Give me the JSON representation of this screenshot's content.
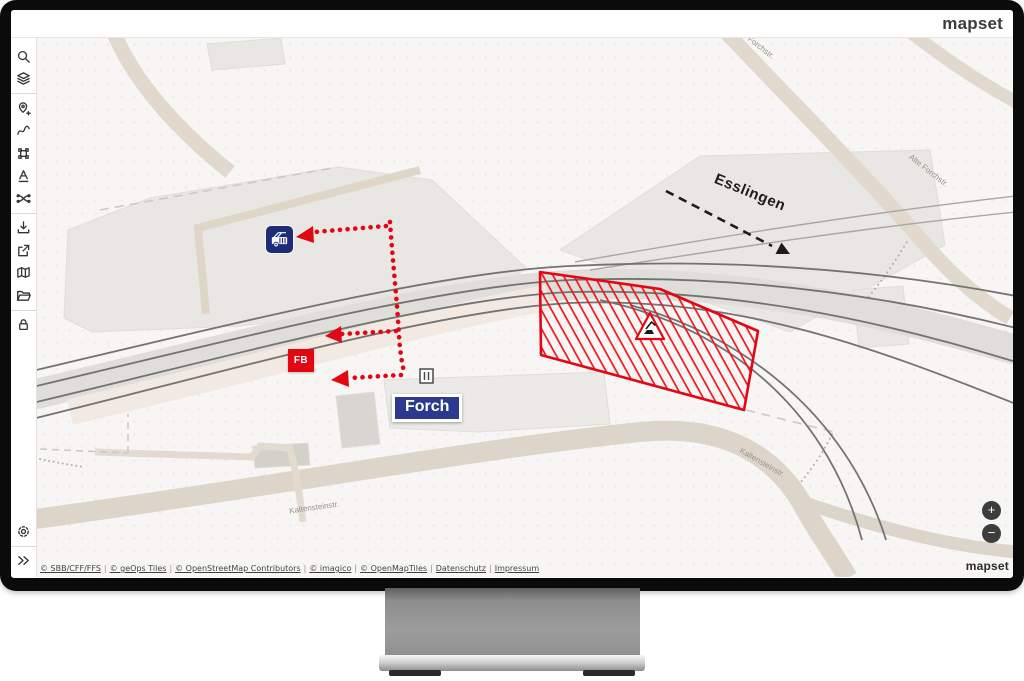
{
  "topbar": {
    "logo": "mapset"
  },
  "sidebar": {
    "icons": [
      "search",
      "layers",
      "add-location",
      "draw-route",
      "transform-selection",
      "add-text",
      "track-switch",
      "download",
      "export-share",
      "map-view",
      "open-folder",
      "lock",
      "settings",
      "collapse-panel"
    ]
  },
  "map": {
    "labels": {
      "esslingen": "Esslingen",
      "forch": "Forch",
      "fb": "FB",
      "alte_forchstr_1": "Alte Forchstr.",
      "alte_forchstr_2": "Alte Forchstr.",
      "kaltensteinstr_1": "Kaltensteinstr.",
      "kaltensteinstr_2": "Kaltensteinstr."
    },
    "controls": {
      "zoom_in": "+",
      "zoom_out": "−",
      "watermark": "mapset"
    },
    "attribution": {
      "separator": "|",
      "items": [
        "© SBB/CFF/FFS",
        "© geOps Tiles",
        "© OpenStreetMap Contributors",
        "© imagico",
        "© OpenMapTiles",
        "Datenschutz",
        "Impressum"
      ]
    },
    "colors": {
      "alert_red": "#e30613",
      "marker_navy": "#2b3a8f",
      "annotation_black": "#1c1c1c"
    }
  }
}
